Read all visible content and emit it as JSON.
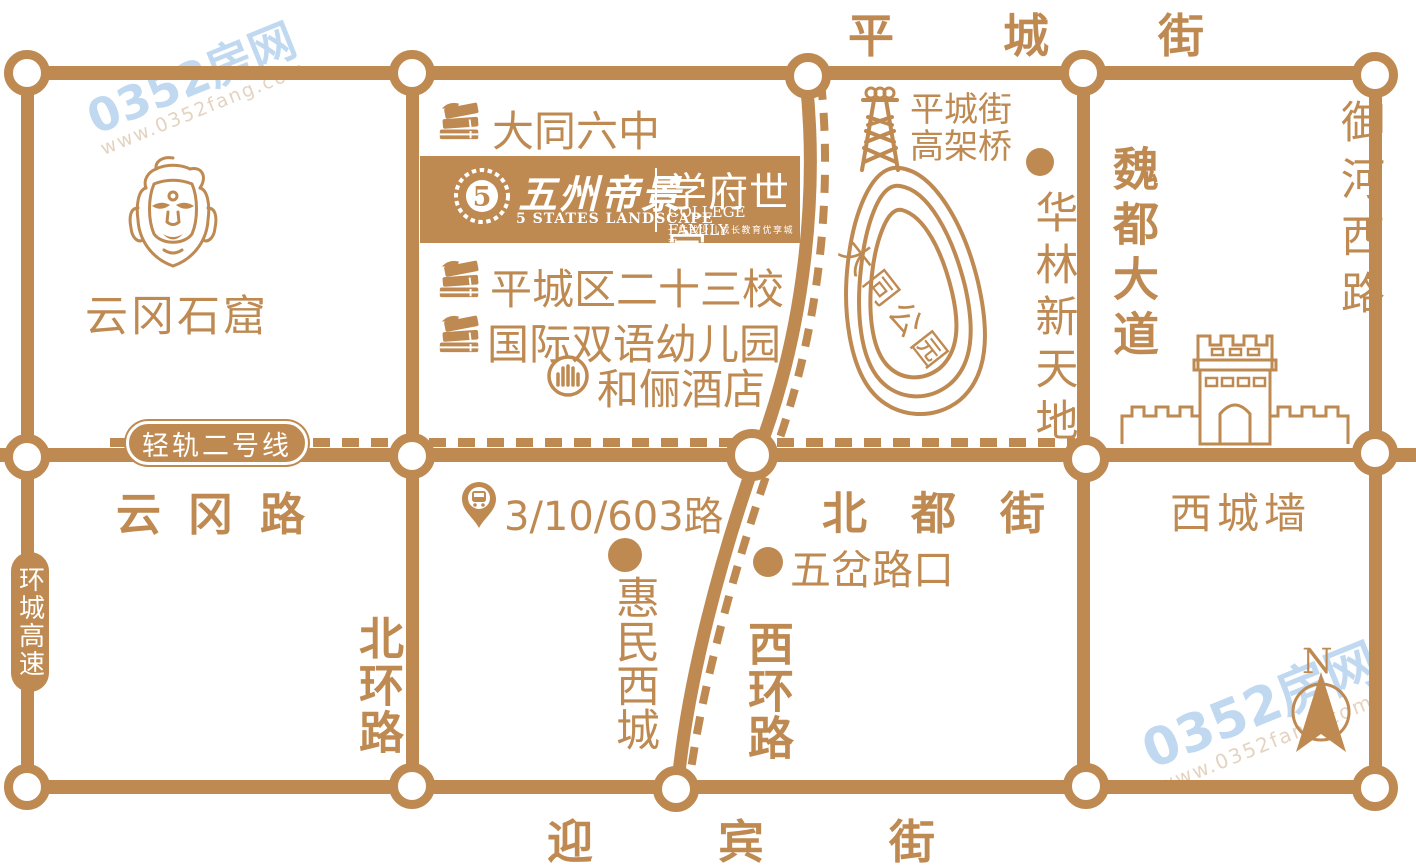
{
  "colors": {
    "primary": "#BE8A52",
    "watermark_blue": "#8CB9E4",
    "white": "#FFFFFF"
  },
  "labels": {
    "top_street": "平城街",
    "yingbin": "迎宾街",
    "yungang_road": "云冈路",
    "beidu": "北都街",
    "xichengqiang": "西城墙",
    "beihuan": "北环路",
    "xihuan": "西环路",
    "weidu": "魏都大道",
    "yuhe": "御河西路",
    "huancheng": "环城高速",
    "lightrail": "轻轨二号线"
  },
  "pois": {
    "datong6": "大同六中",
    "school23": "平城区二十三校",
    "kindergarten": "国际双语幼儿园",
    "hotel": "和俪酒店",
    "viaduct": "平城街高架桥",
    "bus": "3/10/603路",
    "wucha": "五岔路口",
    "huimin": "惠民西城",
    "hualin": "华林新天地"
  },
  "landmarks": {
    "yungang": "云冈石窟",
    "park": "大同公园"
  },
  "logo": {
    "seal_glyph": "5",
    "name_cn": "五州帝景",
    "name_en": "5 STATES LANDSCAPE",
    "sub_cn": "学府世家",
    "sub_en": "COLLEGE FAMILY",
    "tagline": "一站式少儿成长教育优享城邦"
  },
  "compass": {
    "north": "N"
  },
  "watermark": {
    "brand": "0352房网",
    "url": "www.0352fang.com"
  }
}
